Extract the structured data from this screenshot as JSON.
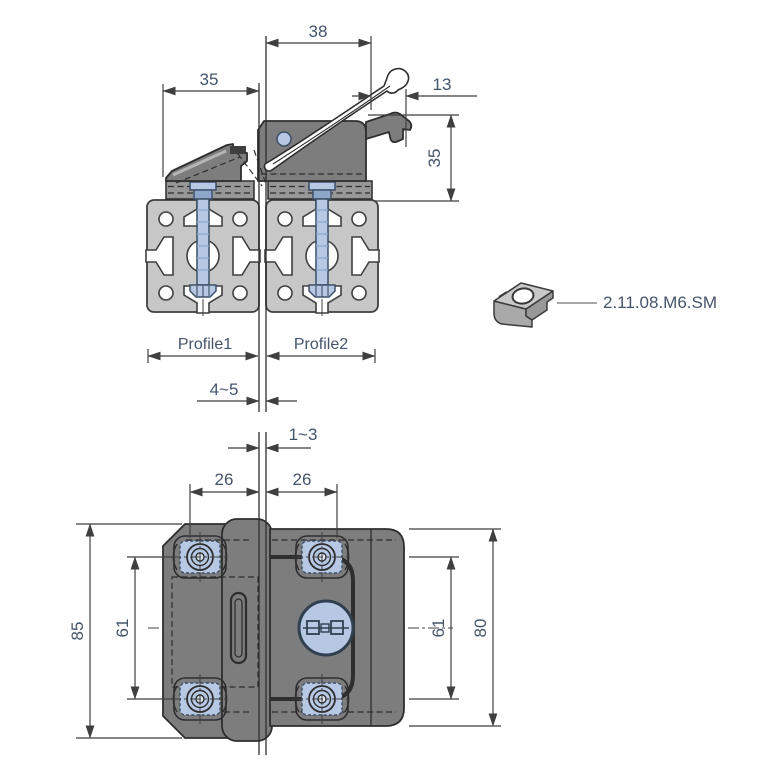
{
  "side_view": {
    "dim_width_38": "38",
    "dim_width_35": "35",
    "dim_offset_13": "13",
    "dim_height_35": "35",
    "profile1_label": "Profile1",
    "profile2_label": "Profile2",
    "dim_gap_45": "4~5"
  },
  "nut_callout": {
    "part_number": "2.11.08.M6.SM"
  },
  "plan_view": {
    "dim_gap_13": "1~3",
    "dim_offset_left_26": "26",
    "dim_offset_right_26": "26",
    "dim_height_85": "85",
    "dim_spacing_left_61": "61",
    "dim_spacing_right_61": "61",
    "dim_height_80": "80"
  },
  "colors": {
    "dimension_text": "#44546a",
    "part_body": "#7d7d7d",
    "profile": "#c7c7c7",
    "fastener": "#b6c8e4",
    "background": "#ffffff"
  }
}
